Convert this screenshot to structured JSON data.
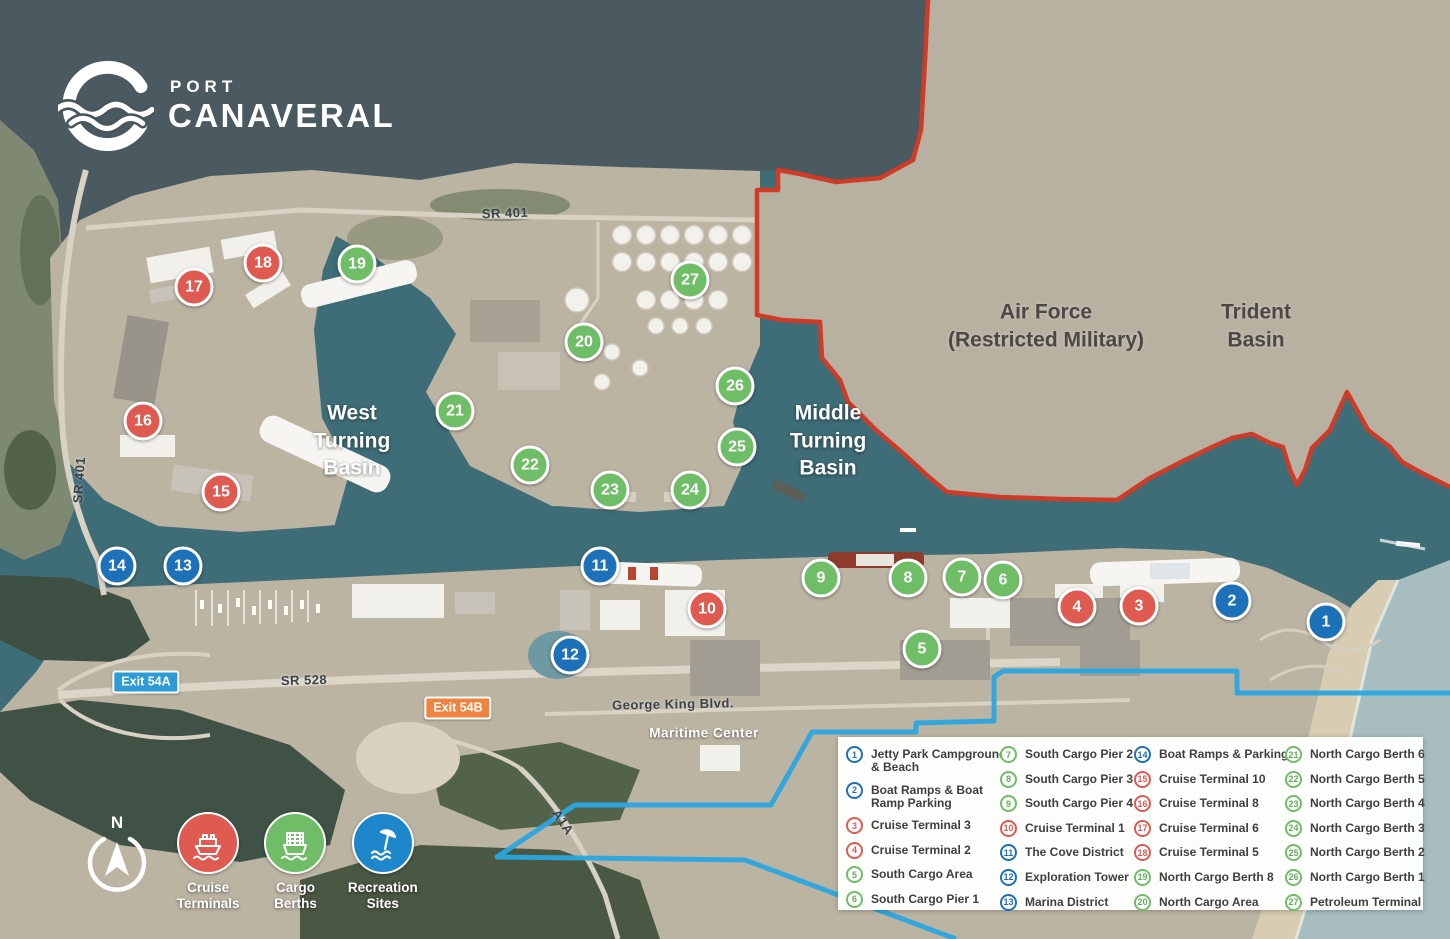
{
  "brand": {
    "line1": "PORT",
    "line2": "CANAVERAL",
    "registered": "®"
  },
  "colors": {
    "cruise_red": "#DF5B52",
    "cargo_green": "#6FBE67",
    "recreation_blue": "#1D71B8",
    "restricted_border": "#CE3B27",
    "restricted_hatch": "#E2826C",
    "jurisdiction_line": "#2BA7DF",
    "exit_a_badge": "#2E9BD6",
    "exit_b_badge": "#F0833F"
  },
  "area_labels": {
    "west_basin": {
      "lines": [
        "West",
        "Turning",
        "Basin"
      ]
    },
    "middle_basin": {
      "lines": [
        "Middle",
        "Turning",
        "Basin"
      ]
    },
    "air_force": {
      "lines": [
        "Air Force",
        "(Restricted Military)"
      ]
    },
    "trident": {
      "lines": [
        "Trident",
        "Basin"
      ]
    }
  },
  "road_labels": {
    "sr401_top": "SR 401",
    "sr401_left": "SR 401",
    "sr528": "SR 528",
    "george_king": "George King Blvd.",
    "a1a": "A1A",
    "maritime_center": "Maritime Center"
  },
  "badges": {
    "exit_a": "Exit 54A",
    "exit_b": "Exit 54B"
  },
  "markers": [
    {
      "n": 1,
      "color": "blue",
      "x": 1326,
      "y": 622,
      "label": "Jetty Park Campground & Beach"
    },
    {
      "n": 2,
      "color": "blue",
      "x": 1232,
      "y": 601,
      "label": "Boat Ramps & Boat Ramp Parking"
    },
    {
      "n": 3,
      "color": "red",
      "x": 1139,
      "y": 606,
      "label": "Cruise Terminal 3"
    },
    {
      "n": 4,
      "color": "red",
      "x": 1077,
      "y": 607,
      "label": "Cruise Terminal 2"
    },
    {
      "n": 5,
      "color": "green",
      "x": 922,
      "y": 649,
      "label": "South Cargo Area"
    },
    {
      "n": 6,
      "color": "green",
      "x": 1003,
      "y": 580,
      "label": "South Cargo Pier 1"
    },
    {
      "n": 7,
      "color": "green",
      "x": 962,
      "y": 577,
      "label": "South Cargo Pier 2"
    },
    {
      "n": 8,
      "color": "green",
      "x": 908,
      "y": 578,
      "label": "South Cargo Pier 3"
    },
    {
      "n": 9,
      "color": "green",
      "x": 821,
      "y": 578,
      "label": "South Cargo Pier 4"
    },
    {
      "n": 10,
      "color": "red",
      "x": 707,
      "y": 609,
      "label": "Cruise Terminal 1"
    },
    {
      "n": 11,
      "color": "blue",
      "x": 600,
      "y": 566,
      "label": "The Cove District"
    },
    {
      "n": 12,
      "color": "blue",
      "x": 570,
      "y": 655,
      "label": "Exploration Tower"
    },
    {
      "n": 13,
      "color": "blue",
      "x": 183,
      "y": 566,
      "label": "Marina District"
    },
    {
      "n": 14,
      "color": "blue",
      "x": 117,
      "y": 566,
      "label": "Boat Ramps & Parking"
    },
    {
      "n": 15,
      "color": "red",
      "x": 221,
      "y": 492,
      "label": "Cruise Terminal 10"
    },
    {
      "n": 16,
      "color": "red",
      "x": 143,
      "y": 421,
      "label": "Cruise Terminal 8"
    },
    {
      "n": 17,
      "color": "red",
      "x": 194,
      "y": 287,
      "label": "Cruise Terminal 6"
    },
    {
      "n": 18,
      "color": "red",
      "x": 263,
      "y": 263,
      "label": "Cruise Terminal 5"
    },
    {
      "n": 19,
      "color": "green",
      "x": 357,
      "y": 264,
      "label": "North Cargo Berth 8"
    },
    {
      "n": 20,
      "color": "green",
      "x": 584,
      "y": 342,
      "label": "North Cargo Area"
    },
    {
      "n": 21,
      "color": "green",
      "x": 455,
      "y": 411,
      "label": "North Cargo Berth 6"
    },
    {
      "n": 22,
      "color": "green",
      "x": 530,
      "y": 465,
      "label": "North Cargo Berth 5"
    },
    {
      "n": 23,
      "color": "green",
      "x": 610,
      "y": 490,
      "label": "North Cargo Berth 4"
    },
    {
      "n": 24,
      "color": "green",
      "x": 690,
      "y": 490,
      "label": "North Cargo Berth 3"
    },
    {
      "n": 25,
      "color": "green",
      "x": 737,
      "y": 447,
      "label": "North Cargo Berth 2"
    },
    {
      "n": 26,
      "color": "green",
      "x": 735,
      "y": 386,
      "label": "North Cargo Berth 1"
    },
    {
      "n": 27,
      "color": "green",
      "x": 690,
      "y": 280,
      "label": "Petroleum Terminal"
    }
  ],
  "legend": {
    "columns": [
      [
        {
          "n": 1,
          "color": "blue",
          "lines": [
            "Jetty Park Campground",
            "& Beach"
          ]
        },
        {
          "n": 2,
          "color": "blue",
          "lines": [
            "Boat Ramps & Boat",
            "Ramp Parking"
          ]
        },
        {
          "n": 3,
          "color": "red",
          "lines": [
            "Cruise Terminal 3"
          ]
        },
        {
          "n": 4,
          "color": "red",
          "lines": [
            "Cruise Terminal 2"
          ]
        },
        {
          "n": 5,
          "color": "green",
          "lines": [
            "South Cargo Area"
          ]
        },
        {
          "n": 6,
          "color": "green",
          "lines": [
            "South Cargo Pier 1"
          ]
        }
      ],
      [
        {
          "n": 7,
          "color": "green",
          "lines": [
            "South Cargo Pier 2"
          ]
        },
        {
          "n": 8,
          "color": "green",
          "lines": [
            "South Cargo Pier 3"
          ]
        },
        {
          "n": 9,
          "color": "green",
          "lines": [
            "South Cargo Pier 4"
          ]
        },
        {
          "n": 10,
          "color": "red",
          "lines": [
            "Cruise Terminal 1"
          ]
        },
        {
          "n": 11,
          "color": "blue",
          "lines": [
            "The Cove District"
          ]
        },
        {
          "n": 12,
          "color": "blue",
          "lines": [
            "Exploration Tower"
          ]
        },
        {
          "n": 13,
          "color": "blue",
          "lines": [
            "Marina District"
          ]
        }
      ],
      [
        {
          "n": 14,
          "color": "blue",
          "lines": [
            "Boat Ramps & Parking"
          ]
        },
        {
          "n": 15,
          "color": "red",
          "lines": [
            "Cruise Terminal 10"
          ]
        },
        {
          "n": 16,
          "color": "red",
          "lines": [
            "Cruise Terminal 8"
          ]
        },
        {
          "n": 17,
          "color": "red",
          "lines": [
            "Cruise Terminal 6"
          ]
        },
        {
          "n": 18,
          "color": "red",
          "lines": [
            "Cruise Terminal 5"
          ]
        },
        {
          "n": 19,
          "color": "green",
          "lines": [
            "North Cargo Berth 8"
          ]
        },
        {
          "n": 20,
          "color": "green",
          "lines": [
            "North Cargo Area"
          ]
        }
      ],
      [
        {
          "n": 21,
          "color": "green",
          "lines": [
            "North Cargo Berth 6"
          ]
        },
        {
          "n": 22,
          "color": "green",
          "lines": [
            "North Cargo Berth 5"
          ]
        },
        {
          "n": 23,
          "color": "green",
          "lines": [
            "North Cargo Berth 4"
          ]
        },
        {
          "n": 24,
          "color": "green",
          "lines": [
            "North Cargo Berth 3"
          ]
        },
        {
          "n": 25,
          "color": "green",
          "lines": [
            "North Cargo Berth 2"
          ]
        },
        {
          "n": 26,
          "color": "green",
          "lines": [
            "North Cargo Berth 1"
          ]
        },
        {
          "n": 27,
          "color": "green",
          "lines": [
            "Petroleum Terminal"
          ]
        }
      ]
    ]
  },
  "key": {
    "compass_label": "N",
    "items": [
      {
        "label": "Cruise Terminals",
        "color": "#DF5B52",
        "icon": "cruise-ship-icon"
      },
      {
        "label": "Cargo Berths",
        "color": "#6FBE67",
        "icon": "cargo-ship-icon"
      },
      {
        "label": "Recreation Sites",
        "color": "#1E87CC",
        "icon": "beach-umbrella-icon"
      }
    ]
  }
}
